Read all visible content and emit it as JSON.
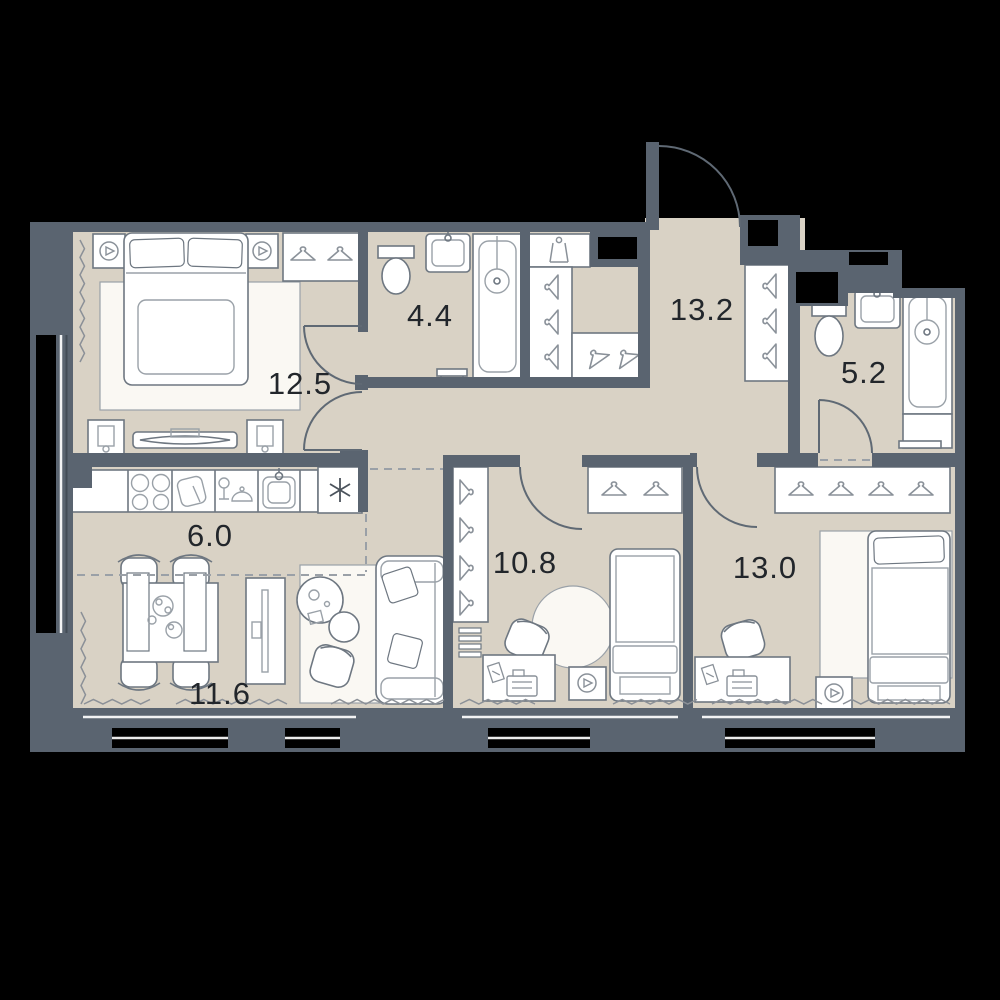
{
  "plan": {
    "type": "apartment-floor-plan",
    "area_units": "m2"
  },
  "rooms": [
    {
      "name": "bedroom-master",
      "area": "12.5",
      "fixtures": [
        "double-bed-icon",
        "speaker-icon",
        "speaker-icon",
        "wardrobe-hangers-icon",
        "nightstand-icon",
        "tv-console-icon",
        "radiator-icon"
      ]
    },
    {
      "name": "bathroom-ensuite",
      "area": "4.4",
      "fixtures": [
        "toilet-icon",
        "sink-icon",
        "bathtub-icon",
        "bench-icon"
      ]
    },
    {
      "name": "hallway",
      "area": "13.2",
      "fixtures": [
        "coat-rack-icon",
        "wardrobe-hangers-icon",
        "entrance-door-arc"
      ]
    },
    {
      "name": "bathroom",
      "area": "5.2",
      "fixtures": [
        "toilet-icon",
        "sink-icon",
        "bathtub-icon",
        "bench-icon"
      ]
    },
    {
      "name": "kitchen",
      "area": "6.0",
      "fixtures": [
        "hob-icon",
        "cutting-board-icon",
        "wine-glass-icon",
        "kitchen-sink-icon",
        "appliance-asterisk-icon"
      ]
    },
    {
      "name": "bedroom-2",
      "area": "10.8",
      "fixtures": [
        "single-bed-icon",
        "wardrobe-hangers-icon",
        "closet-column-icon",
        "desk-icon",
        "armchair-icon",
        "round-rug-icon",
        "speaker-icon",
        "radiator-icon"
      ]
    },
    {
      "name": "bedroom-3",
      "area": "13.0",
      "fixtures": [
        "double-bed-icon",
        "wardrobe-hangers-icon",
        "desk-icon",
        "office-chair-icon",
        "speaker-icon",
        "radiator-icon"
      ]
    },
    {
      "name": "living-room",
      "area": "11.6",
      "fixtures": [
        "dining-table-icon",
        "chair-icon",
        "sofa-icon",
        "coffee-table-icon",
        "tv-stand-icon",
        "armchair-icon",
        "radiator-icon"
      ]
    }
  ],
  "colors": {
    "background": "#000000",
    "wall": "#5a6470",
    "floor": "#d9d2c5",
    "furniture_line": "#6e7781",
    "furniture_line_light": "#9aa1a8",
    "furniture_fill": "#ffffff",
    "rug_fill": "#faf8f3",
    "label_text": "#22262b",
    "door_arc": "#5f6974",
    "dashed_zone_line": "#9aa0a7",
    "radiator_zigzag": "#8b9097",
    "window_glass": "#434c56"
  }
}
